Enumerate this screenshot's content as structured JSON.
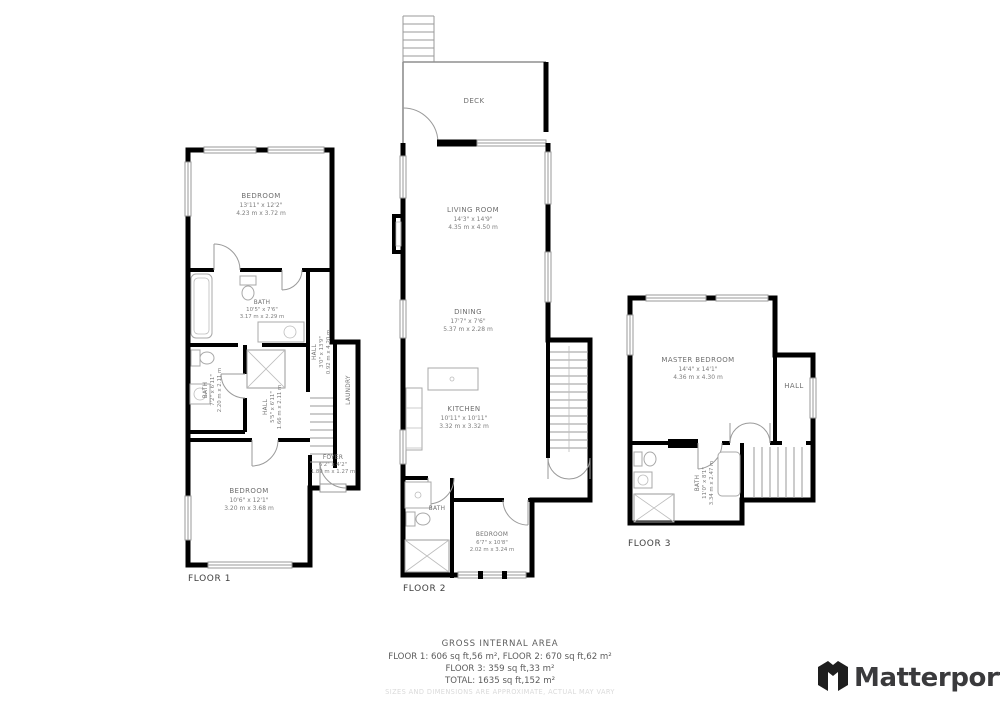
{
  "floor1": {
    "label": "FLOOR 1",
    "bedroom_top": {
      "name": "BEDROOM",
      "ft": "13'11\" x 12'2\"",
      "m": "4.23 m x 3.72 m"
    },
    "bath_top": {
      "name": "BATH",
      "ft": "10'5\" x 7'6\"",
      "m": "3.17 m x 2.29 m"
    },
    "hall_right": {
      "name": "HALL",
      "ft": "3'0\" x 13'9\"",
      "m": "0.92 m x 4.20 m"
    },
    "bath_left": {
      "name": "BATH",
      "ft": "7'2\" x 6'11\"",
      "m": "2.20 m x 2.11 m"
    },
    "hall_center": {
      "name": "HALL",
      "ft": "5'5\" x 6'11\"",
      "m": "1.66 m x 2.11 m"
    },
    "laundry": {
      "name": "LAUNDRY"
    },
    "foyer": {
      "name": "FOYER",
      "ft": "6'2\" x 4'2\"",
      "m": "1.89 m x 1.27 m"
    },
    "bedroom_bottom": {
      "name": "BEDROOM",
      "ft": "10'6\" x 12'1\"",
      "m": "3.20 m x 3.68 m"
    }
  },
  "floor2": {
    "label": "FLOOR 2",
    "deck": {
      "name": "DECK"
    },
    "living": {
      "name": "LIVING ROOM",
      "ft": "14'3\" x 14'9\"",
      "m": "4.35 m x 4.50 m"
    },
    "dining": {
      "name": "DINING",
      "ft": "17'7\" x 7'6\"",
      "m": "5.37 m x 2.28 m"
    },
    "kitchen": {
      "name": "KITCHEN",
      "ft": "10'11\" x 10'11\"",
      "m": "3.32 m x 3.32 m"
    },
    "bath": {
      "name": "BATH"
    },
    "bedroom": {
      "name": "BEDROOM",
      "ft": "6'7\" x 10'8\"",
      "m": "2.02 m x 3.24 m"
    }
  },
  "floor3": {
    "label": "FLOOR 3",
    "master": {
      "name": "MASTER BEDROOM",
      "ft": "14'4\" x 14'1\"",
      "m": "4.36 m x 4.30 m"
    },
    "hall": {
      "name": "HALL"
    },
    "bath": {
      "name": "BATH",
      "ft": "11'0\" x 8'1\"",
      "m": "3.34 m x 2.47 m"
    }
  },
  "summary": {
    "title": "GROSS INTERNAL AREA",
    "line1": "FLOOR 1: 606 sq ft,56 m², FLOOR 2: 670 sq ft,62 m²",
    "line2": "FLOOR 3: 359 sq ft,33 m²",
    "line3": "TOTAL: 1635 sq ft,152 m²",
    "disclaimer": "SIZES AND DIMENSIONS ARE APPROXIMATE, ACTUAL MAY VARY"
  },
  "branding": {
    "name": "Matterport"
  }
}
